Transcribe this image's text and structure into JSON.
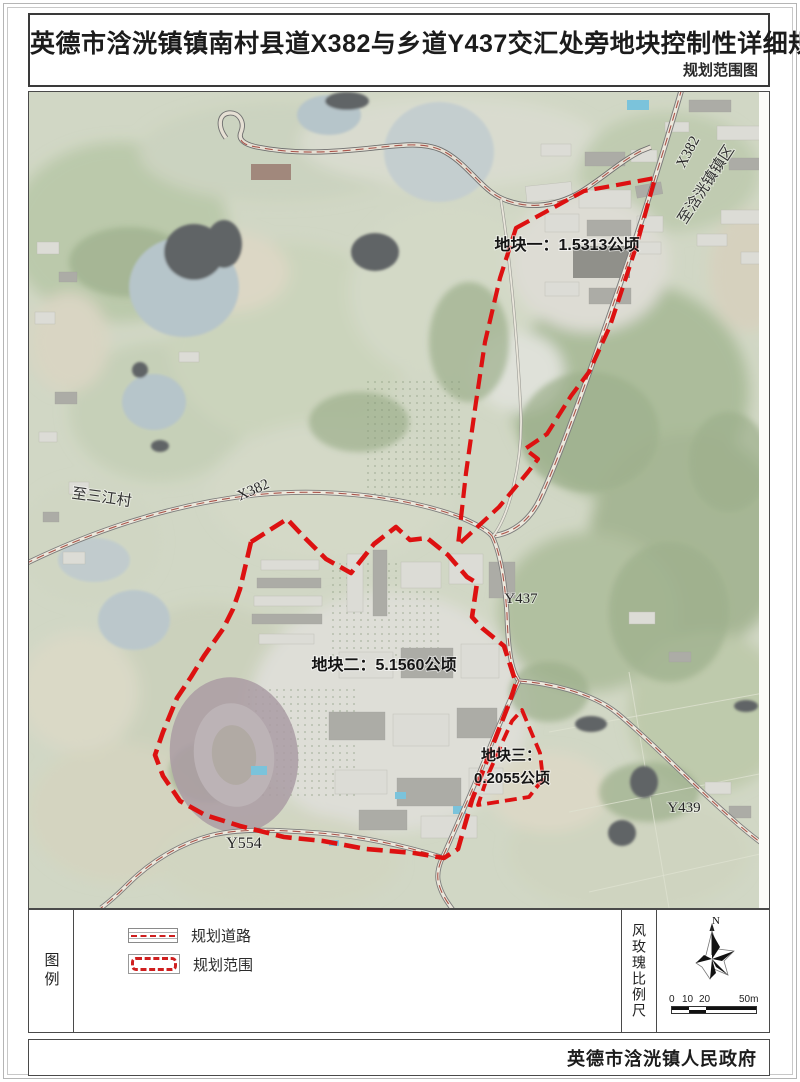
{
  "colors": {
    "boundary-red": "#dd1111",
    "road-center-red": "#a9544b",
    "symbol-red": "#cf1f1f",
    "map-base": "#c9d0ba"
  },
  "header": {
    "title": "英德市浛洸镇镇南村县道X382与乡道Y437交汇处旁地块控制性详细规划",
    "subtitle": "规划范围图"
  },
  "map": {
    "plots": [
      {
        "id": "plot-1",
        "label": "地块一：1.5313公顷"
      },
      {
        "id": "plot-2",
        "label": "地块二：5.1560公顷"
      },
      {
        "id": "plot-3",
        "label_line1": "地块三：",
        "label_line2": "0.2055公顷"
      }
    ],
    "road_labels": {
      "x382_ne": "X382",
      "to_hanguang": "至浛洸镇镇区",
      "x382_w": "X382",
      "to_sanjiang": "至三江村",
      "y437": "Y437",
      "y439": "Y439",
      "y554": "Y554"
    }
  },
  "legend": {
    "section_label": "图例",
    "items": [
      {
        "symbol": "planned-road",
        "label": "规划道路"
      },
      {
        "symbol": "planning-scope",
        "label": "规划范围"
      }
    ],
    "windrose_scale_label": "风玫瑰比例尺",
    "north_label": "N",
    "scalebar": {
      "n0": "0",
      "n10": "10",
      "n20": "20",
      "n50": "50m"
    }
  },
  "footer": {
    "publisher": "英德市浛洸镇人民政府"
  }
}
